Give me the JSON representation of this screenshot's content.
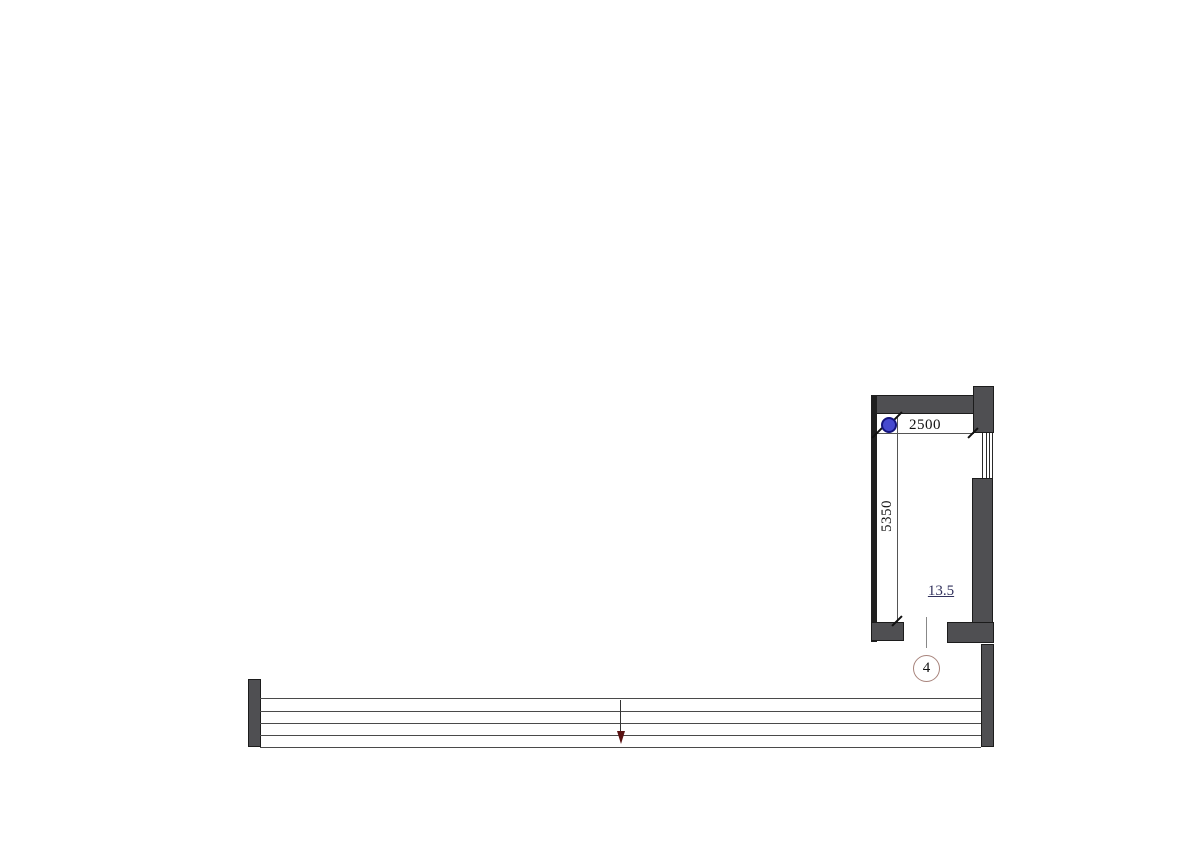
{
  "page": {
    "background": "#ffffff",
    "kind": "floor-plan-drawing"
  },
  "floor_plan": {
    "dimensions": [
      {
        "id": "room-width",
        "label": "2500",
        "orientation": "horizontal"
      },
      {
        "id": "room-height",
        "label": "5350",
        "orientation": "vertical"
      }
    ],
    "room": {
      "area_label": "13.5"
    },
    "callout": {
      "number": "4"
    },
    "icons": {
      "column_marker": "filled-blue-circle-marker",
      "flow_arrow": "arrow-down",
      "dimension_tick": "slash-tick"
    },
    "colors": {
      "wall_fill": "#4f4f52",
      "wall_outline": "#1c1c1c",
      "partition_wall": "#1f1f1f",
      "marker_fill": "#4649cf",
      "marker_border": "#14147d",
      "area_text": "#31315c",
      "callout_ring": "#a8847c",
      "arrow_head": "#5a1212",
      "section_lines": "#4a4a4a",
      "dimension_lines": "#555555"
    }
  }
}
